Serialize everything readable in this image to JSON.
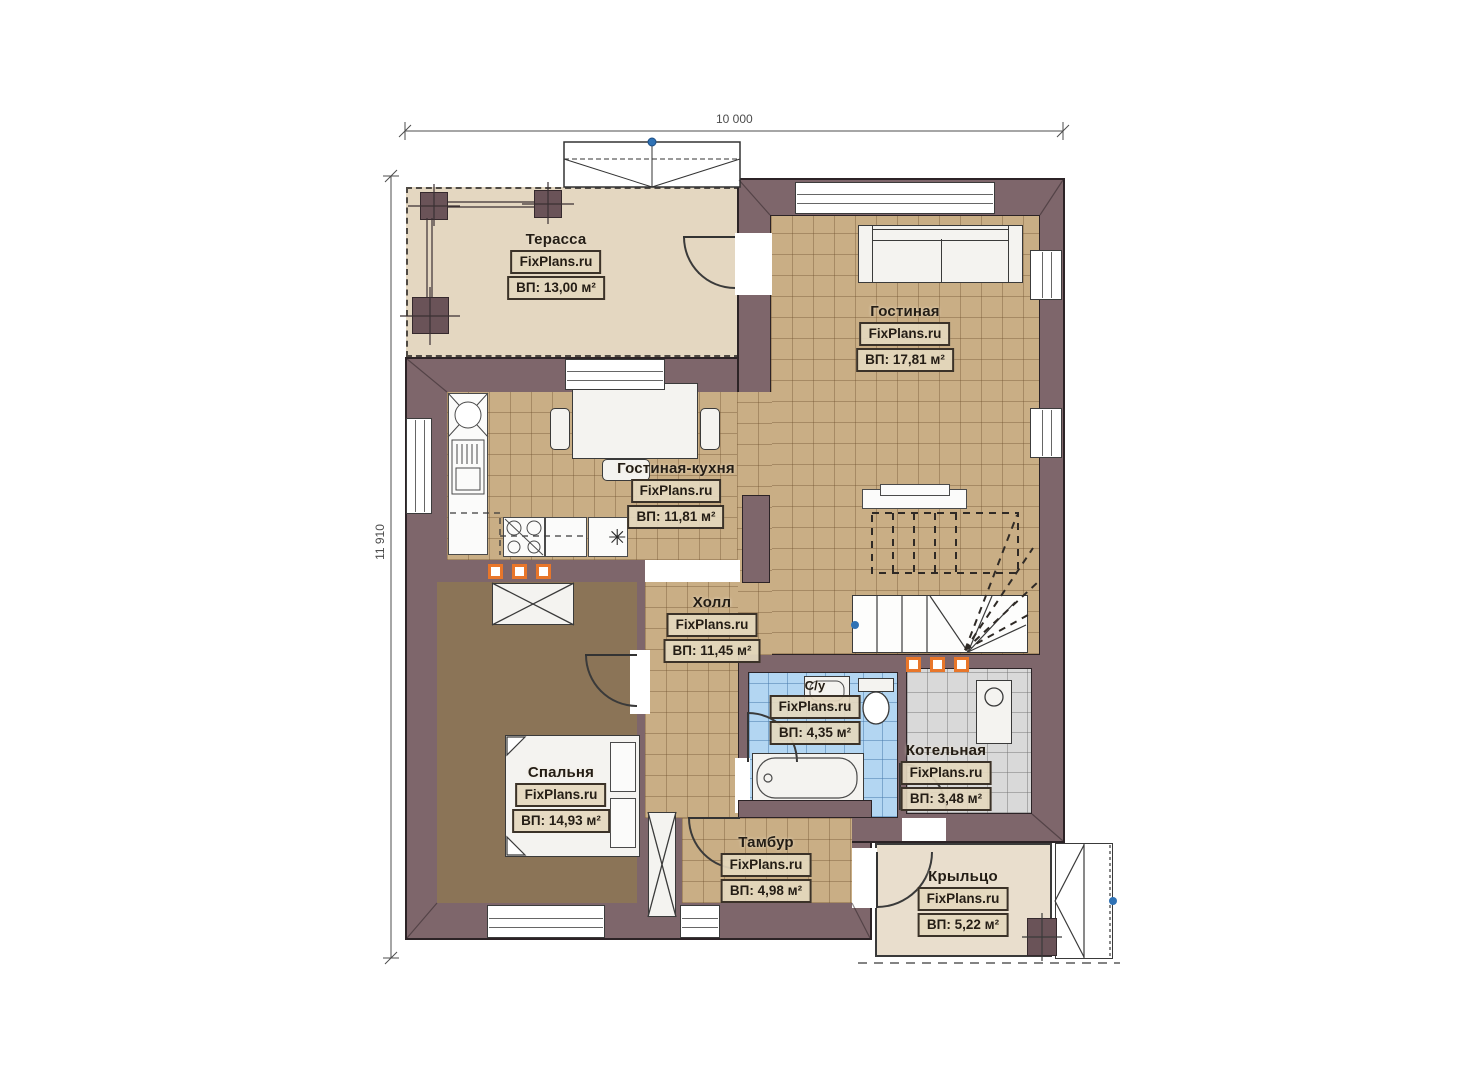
{
  "plan": {
    "type": "floor-plan",
    "watermark": "FixPlans.ru"
  },
  "dimensions": {
    "width_label": "10 000",
    "height_label": "11 910"
  },
  "rooms": [
    {
      "key": "terrace",
      "name": "Терасса",
      "brand": "FixPlans.ru",
      "area": "ВП: 13,00 м²"
    },
    {
      "key": "living",
      "name": "Гостиная",
      "brand": "FixPlans.ru",
      "area": "ВП: 17,81 м²"
    },
    {
      "key": "kitchen",
      "name": "Гостиная-кухня",
      "brand": "FixPlans.ru",
      "area": "ВП: 11,81 м²"
    },
    {
      "key": "hall",
      "name": "Холл",
      "brand": "FixPlans.ru",
      "area": "ВП: 11,45 м²"
    },
    {
      "key": "bedroom",
      "name": "Спальня",
      "brand": "FixPlans.ru",
      "area": "ВП: 14,93 м²"
    },
    {
      "key": "bathroom",
      "name": "С/у",
      "brand": "FixPlans.ru",
      "area": "ВП: 4,35 м²"
    },
    {
      "key": "boiler",
      "name": "Котельная",
      "brand": "FixPlans.ru",
      "area": "ВП: 3,48 м²"
    },
    {
      "key": "tambur",
      "name": "Тамбур",
      "brand": "FixPlans.ru",
      "area": "ВП: 4,98 м²"
    },
    {
      "key": "porch",
      "name": "Крыльцо",
      "brand": "FixPlans.ru",
      "area": "ВП: 5,22 м²"
    }
  ],
  "icons": {
    "fridge_snowflake": "✳"
  },
  "colors": {
    "wall": "#7e666b",
    "tile_floor": "#c9ae85",
    "bedroom_floor": "#8b7457",
    "terrace_floor": "#e4d7c1",
    "porch_floor": "#e9decd",
    "bathroom_floor": "#b3d6f2",
    "boiler_floor": "#d9d9d9",
    "vent_accent": "#e8762a",
    "marker_blue": "#2f72b5"
  }
}
